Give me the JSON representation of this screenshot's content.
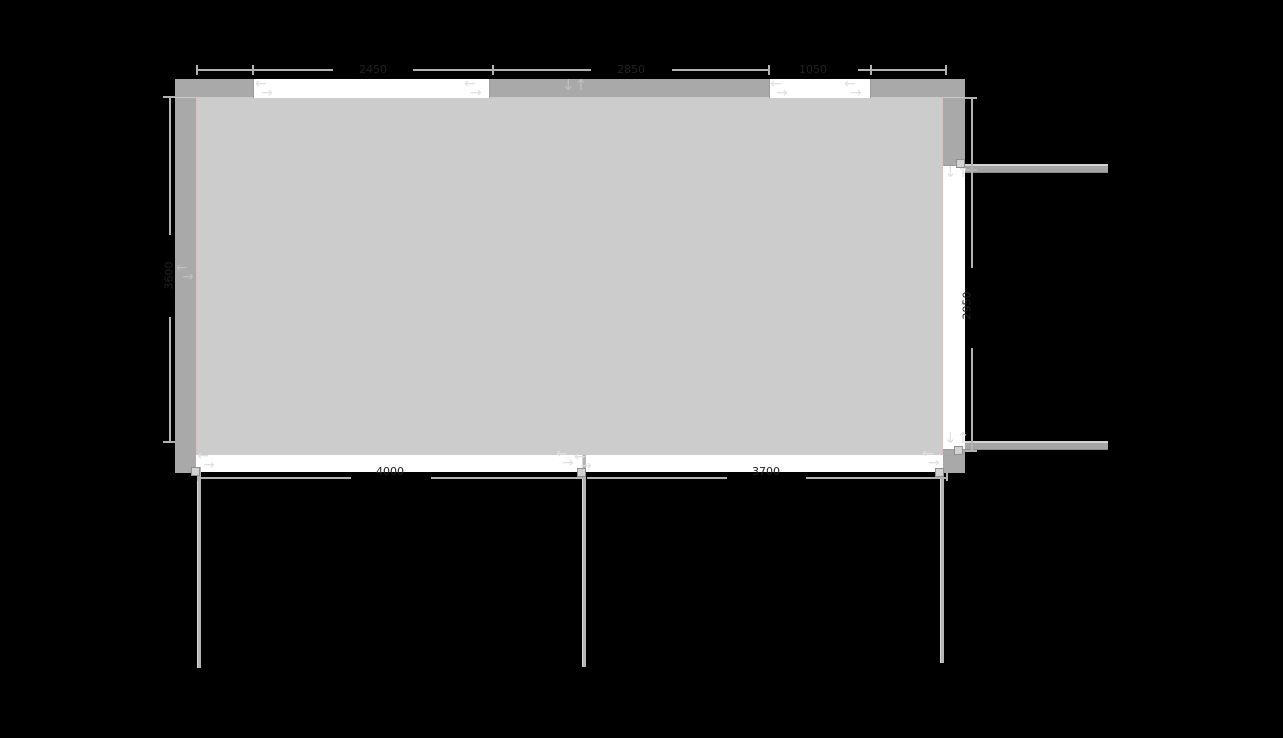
{
  "app": {
    "view": "floor-plan-editor-canvas",
    "background_color": "#000000"
  },
  "plan": {
    "colors": {
      "wall": "#a9a9a9",
      "floor": "#cccccc",
      "opening": "#ffffff",
      "wall_inner_edge": "#d8c3c3",
      "dimension_line": "#b3b3b3",
      "dimension_text": "#222222",
      "handle_fill": "#d2d2d2",
      "arrow_on_white": "#e0e0e0",
      "arrow_on_wall": "#bfbfbf"
    },
    "dimension_labels": {
      "top_window_1": "2450",
      "top_wall_mid": "2850",
      "top_window_2": "1050",
      "left_wall": "3600",
      "right_opening": "2950",
      "bottom_opening_1": "4000",
      "bottom_opening_2": "3700"
    },
    "icons": {
      "swap_horizontal": "← over →",
      "swap_vertical": "↓↑",
      "swap_h_left_glyph": "←",
      "swap_h_right_glyph": "→",
      "swap_v_glyph": "↓↑"
    }
  }
}
